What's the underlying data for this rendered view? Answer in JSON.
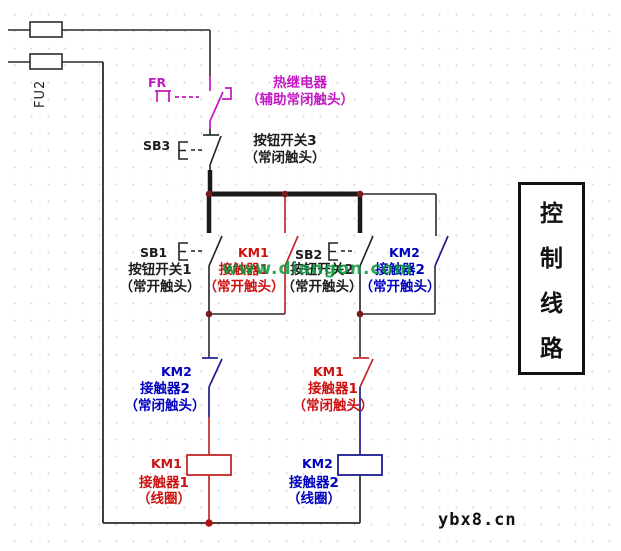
{
  "fuse": {
    "ref": "FU2"
  },
  "thermal_relay": {
    "ref": "FR",
    "name": "热继电器",
    "desc": "（辅助常闭触头）"
  },
  "stop_button": {
    "ref": "SB3",
    "name": "按钮开关3",
    "desc": "（常闭触头）"
  },
  "start_row": [
    {
      "ref": "SB1",
      "name": "按钮开关1",
      "desc": "（常开触头）"
    },
    {
      "ref": "KM1",
      "name": "接触器1",
      "desc": "（常开触头）"
    },
    {
      "ref": "SB2",
      "name": "按钮开关2",
      "desc": "（常开触头）"
    },
    {
      "ref": "KM2",
      "name": "接触器2",
      "desc": "（常开触头）"
    }
  ],
  "interlock_row": [
    {
      "ref": "KM2",
      "name": "接触器2",
      "desc": "（常闭触头）"
    },
    {
      "ref": "KM1",
      "name": "接触器1",
      "desc": "（常闭触头）"
    }
  ],
  "coil_row": [
    {
      "ref": "KM1",
      "name": "接触器1",
      "desc": "（线圈）"
    },
    {
      "ref": "KM2",
      "name": "接触器2",
      "desc": "（线圈）"
    }
  ],
  "side_label": {
    "chars": [
      "控",
      "制",
      "线",
      "路"
    ]
  },
  "watermarks": {
    "green": "www.diangon.com",
    "site": "ybx8.cn"
  },
  "colors": {
    "wire": "#2b2b2b",
    "magenta": "#c318c3",
    "red": "#cc1111",
    "blue": "#0000c0",
    "navy": "#1c1c90",
    "junction_dot": "#7a1a1a",
    "bottom_dot": "#b31111",
    "green_watermark": "#0a9a3c"
  }
}
